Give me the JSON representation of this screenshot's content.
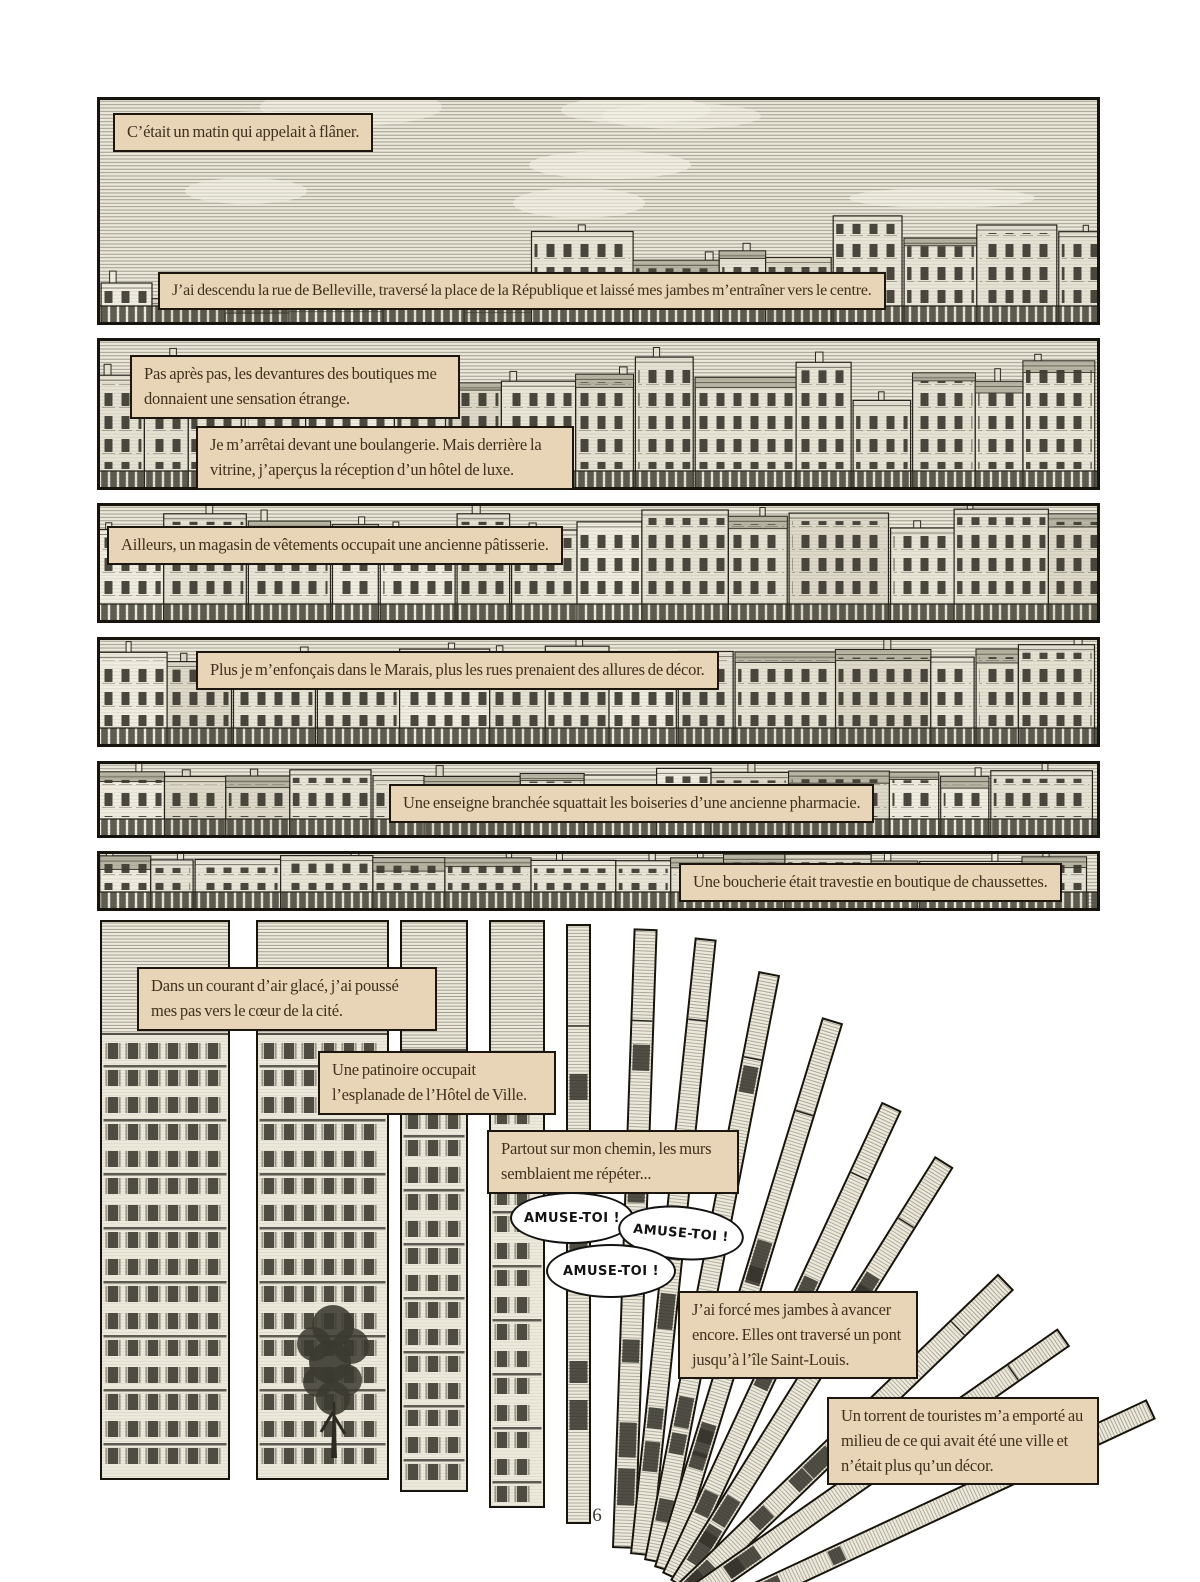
{
  "page": {
    "number": "6"
  },
  "captions": {
    "morning": "C’était un matin qui appelait à flâner.",
    "belleville": "J’ai descendu la rue de Belleville, traversé la place de la République et laissé mes jambes m’entraîner vers le centre.",
    "devantures": "Pas après pas, les devantures des boutiques me donnaient une sensation étrange.",
    "boulangerie": "Je m’arrêtai devant une boulangerie. Mais derrière la vitrine, j’aperçus la réception d’un hôtel de luxe.",
    "patisserie": "Ailleurs, un magasin de vêtements occupait une ancienne pâtisserie.",
    "marais": "Plus je m’enfonçais dans le Marais, plus les rues prenaient des allures de décor.",
    "pharmacie": "Une enseigne branchée squattait les boiseries d’une ancienne pharmacie.",
    "boucherie": "Une boucherie était travestie en boutique de chaussettes.",
    "courant": "Dans un courant d’air glacé, j’ai poussé mes pas vers le cœur de la cité.",
    "patinoire": "Une patinoire occupait l’esplanade de l’Hôtel de Ville.",
    "partout": "Partout sur mon chemin, les murs semblaient me répéter...",
    "jambes": "J’ai forcé mes jambes à avancer encore. Elles ont traversé un pont jusqu’à l’île Saint-Louis.",
    "torrent": "Un torrent de touristes m’a emporté au milieu de ce qui avait été une ville et n’était plus qu’un décor."
  },
  "bubbles": {
    "amuse1": "AMUSE-TOI !",
    "amuse2": "AMUSE-TOI !",
    "amuse3": "AMUSE-TOI !"
  },
  "colors": {
    "paper": "#ffffff",
    "ink": "#17140d",
    "panel_bg": "#ece9db",
    "caption_bg": "#e8d5b7",
    "caption_border": "#1c160e",
    "bubble_bg": "#ffffff"
  }
}
